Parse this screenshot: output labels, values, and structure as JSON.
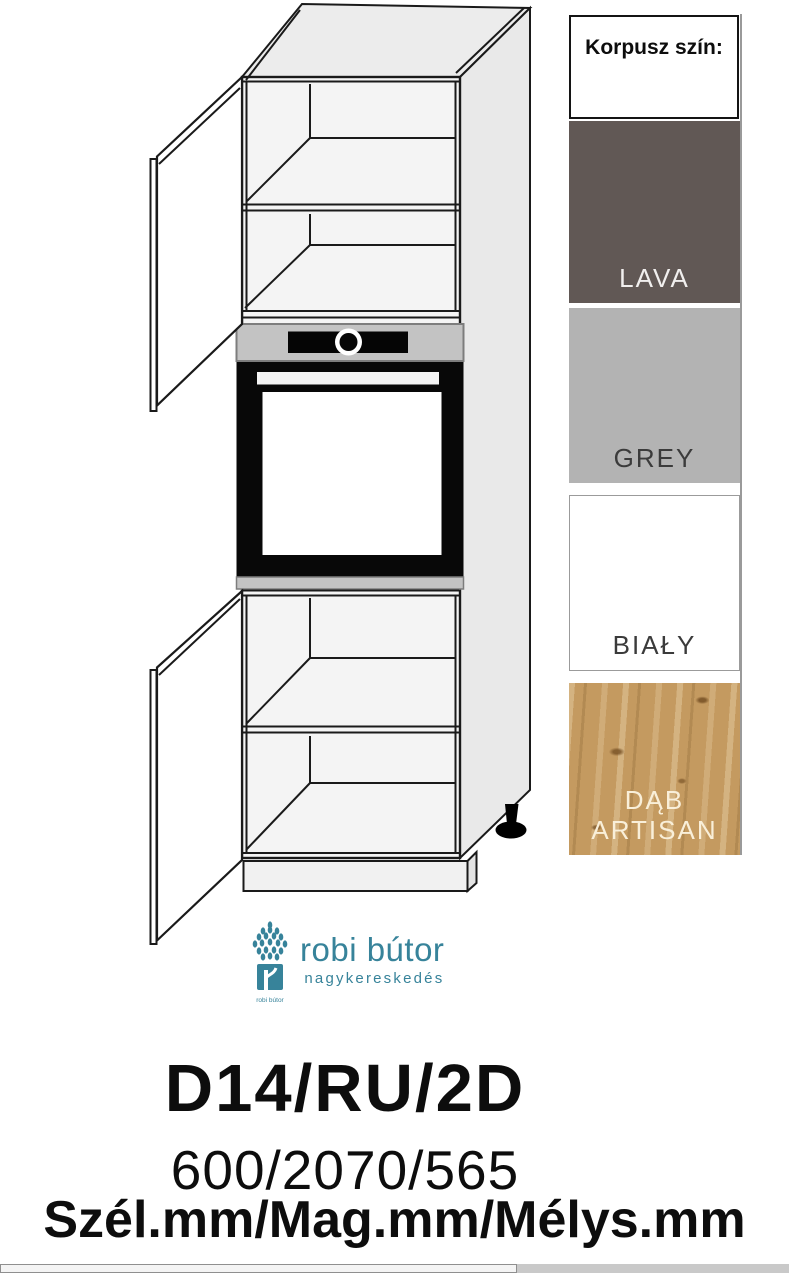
{
  "product": {
    "code": "D14/RU/2D",
    "dimensions": "600/2070/565",
    "dimensions_label": "Szél.mm/Mag.mm/Mélys.mm"
  },
  "color_panel": {
    "title": "Korpusz szín:",
    "swatches": [
      {
        "label": "LAVA",
        "color": "#615855",
        "text_color": "#f1efee"
      },
      {
        "label": "GREY",
        "color": "#b3b3b3",
        "text_color": "#3b3b3b"
      },
      {
        "label": "BIAŁY",
        "color": "#ffffff",
        "text_color": "#3b3b3b",
        "border_visible": true
      },
      {
        "label": "DĄB ARTISAN",
        "color": "#c49a60",
        "text_color": "#f9efd9",
        "texture": "wood"
      }
    ]
  },
  "logo": {
    "icon": "tree-icon",
    "icon_caption": "robi bútor",
    "name": "robi bútor",
    "subtitle": "nagykereskedés",
    "accent_color": "#37839a"
  },
  "drawing": {
    "description": "Tall oven-housing kitchen cabinet in 3D view: two open doors, four shelf compartments, built-in oven with knob, plinth and black adjustable foot",
    "line_color": "#1a1a1a",
    "oven_panel_color": "#c3c3c3"
  }
}
